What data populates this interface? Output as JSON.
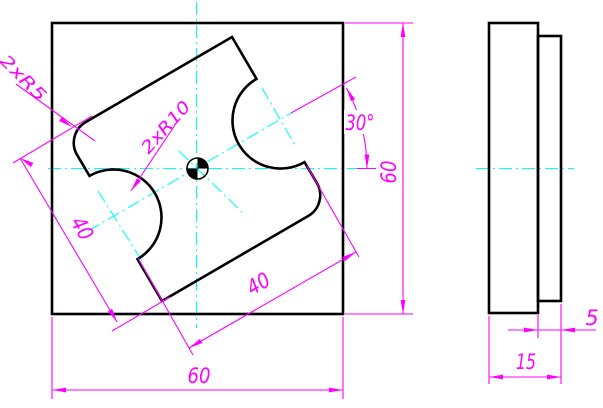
{
  "drawing": {
    "title": "two-view engineering drawing of square plate with rotated slotted boss",
    "colors": {
      "background": "#FFFFFF",
      "outline": "#000000",
      "dimension": "#FF00FF",
      "centerline": "#00FFFF"
    },
    "front_view": {
      "width_dim": "60",
      "height_dim": "60",
      "slot_length_dim": "40",
      "slot_width_dim": "40",
      "slot_angle_dim": "30°",
      "corner_radius_label": "2xR5",
      "notch_radius_label": "2xR10"
    },
    "side_view": {
      "total_thickness_dim": "15",
      "boss_thickness_dim": "5"
    }
  }
}
